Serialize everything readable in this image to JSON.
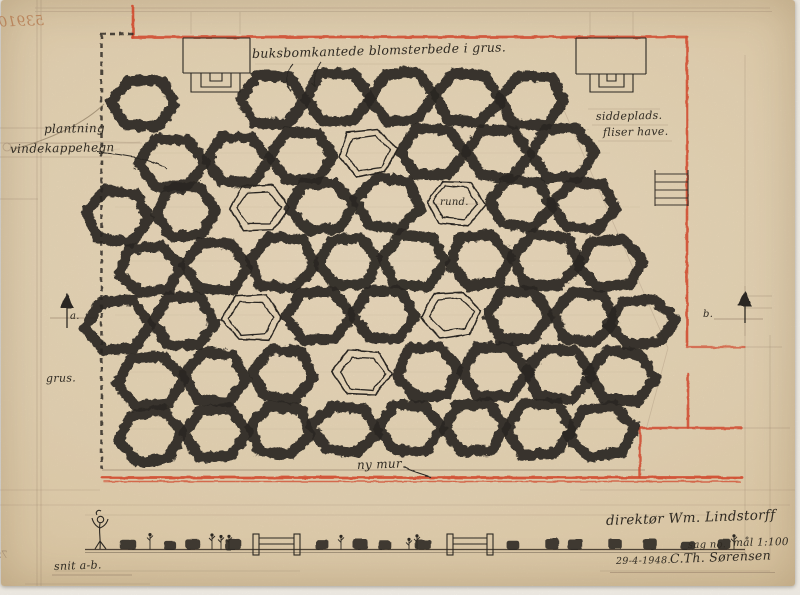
{
  "meta": {
    "ghost_number": "53910",
    "stamp_mirrored": "799-1"
  },
  "annotations": {
    "top_note": "buksbomkantede blomsterbede i grus.",
    "planting": "plantning",
    "fence": "vindekappehegn",
    "seating": "siddeplads.",
    "tiles": "fliser have.",
    "gravel": "grus.",
    "marker_a": "a.",
    "marker_b": "b.",
    "hex_label": "rund.",
    "new_wall": "ny mur",
    "section_label": "snit a-b."
  },
  "titleblock": {
    "client": "direktør Wm. Lindstorff",
    "case_label": "sag no.",
    "scale": "mål 1:100",
    "date": "29-4-1948.",
    "signature": "C.Th. Sørensen"
  },
  "plan": {
    "hexes": [
      [
        143,
        103,
        "r"
      ],
      [
        272,
        100,
        "r"
      ],
      [
        337,
        98,
        "r"
      ],
      [
        402,
        97,
        "r"
      ],
      [
        467,
        98,
        "r"
      ],
      [
        532,
        100,
        "r"
      ],
      [
        172,
        163,
        "r"
      ],
      [
        237,
        159,
        "r"
      ],
      [
        302,
        156,
        "r"
      ],
      [
        367,
        153,
        "o"
      ],
      [
        432,
        152,
        "r"
      ],
      [
        497,
        153,
        "r"
      ],
      [
        562,
        153,
        "r"
      ],
      [
        118,
        216,
        "r"
      ],
      [
        185,
        212,
        "r"
      ],
      [
        258,
        208,
        "o"
      ],
      [
        322,
        206,
        "r"
      ],
      [
        388,
        204,
        "r"
      ],
      [
        455,
        203,
        "ol"
      ],
      [
        520,
        204,
        "r"
      ],
      [
        585,
        206,
        "r"
      ],
      [
        150,
        270,
        "r"
      ],
      [
        216,
        266,
        "r"
      ],
      [
        282,
        263,
        "r"
      ],
      [
        348,
        261,
        "r"
      ],
      [
        414,
        260,
        "r"
      ],
      [
        480,
        260,
        "r"
      ],
      [
        546,
        261,
        "r"
      ],
      [
        610,
        263,
        "r"
      ],
      [
        118,
        326,
        "r"
      ],
      [
        184,
        322,
        "r"
      ],
      [
        252,
        318,
        "o"
      ],
      [
        318,
        316,
        "r"
      ],
      [
        384,
        315,
        "r"
      ],
      [
        452,
        314,
        "o"
      ],
      [
        518,
        315,
        "r"
      ],
      [
        584,
        317,
        "r"
      ],
      [
        642,
        322,
        "r"
      ],
      [
        150,
        381,
        "r"
      ],
      [
        216,
        377,
        "r"
      ],
      [
        282,
        374,
        "r"
      ],
      [
        362,
        373,
        "o"
      ],
      [
        428,
        372,
        "r"
      ],
      [
        494,
        372,
        "r"
      ],
      [
        558,
        373,
        "r"
      ],
      [
        622,
        376,
        "r"
      ],
      [
        150,
        437,
        "r"
      ],
      [
        215,
        433,
        "r"
      ],
      [
        280,
        431,
        "r"
      ],
      [
        345,
        429,
        "r"
      ],
      [
        410,
        428,
        "r"
      ],
      [
        475,
        428,
        "r"
      ],
      [
        540,
        429,
        "r"
      ],
      [
        602,
        431,
        "r"
      ]
    ]
  },
  "section": {
    "shrubs": [
      128,
      170,
      193,
      233,
      322,
      360,
      385,
      423,
      513,
      552,
      575,
      615,
      650,
      688,
      724
    ],
    "plants": [
      150,
      212,
      221,
      229,
      341,
      409,
      417,
      734
    ],
    "benches": [
      {
        "x": 253,
        "w": 47
      },
      {
        "x": 447,
        "w": 46
      }
    ],
    "figure_x": 100
  },
  "colors": {
    "paper": "#e9d7b8",
    "ink": "#2c2822",
    "pencil": "#8a7460",
    "red": "#d0492e",
    "ghost": "#b5794e"
  }
}
